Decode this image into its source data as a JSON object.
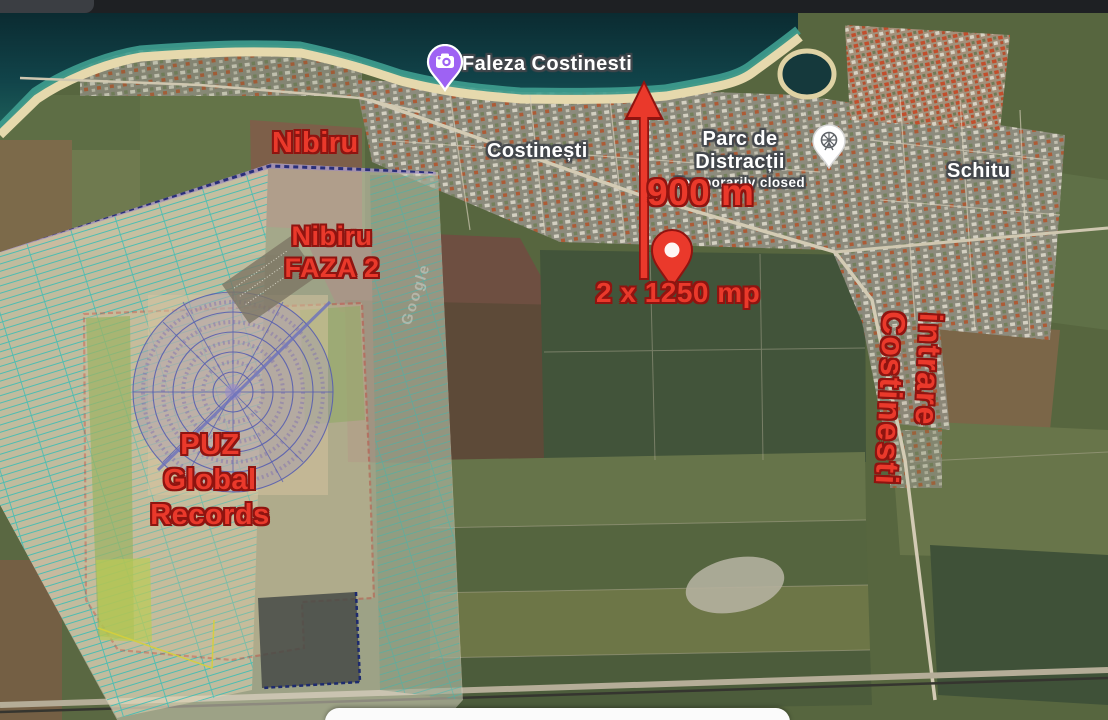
{
  "map_labels": {
    "faleza": {
      "label": "Faleza Costinesti",
      "icon": "camera-pin",
      "pin_color": "#9e62f3"
    },
    "costinesti": {
      "label": "Costinești"
    },
    "parc": {
      "label": "Parc de Distracții",
      "status": "Temporarily closed",
      "icon": "amusement-park-pin"
    },
    "schitu": {
      "label": "Schitu"
    }
  },
  "annotations": {
    "color": "#ea392b",
    "nibiru": "Nibiru",
    "faza2": {
      "line1": "Nibiru",
      "line2": "FAZA 2"
    },
    "distance": "900 m",
    "plots": "2 x 1250 mp",
    "entrance": "intrare Costinesti",
    "puz": {
      "line1": "PUZ",
      "line2": "Global",
      "line3": "Records"
    }
  },
  "watermark": "Google"
}
